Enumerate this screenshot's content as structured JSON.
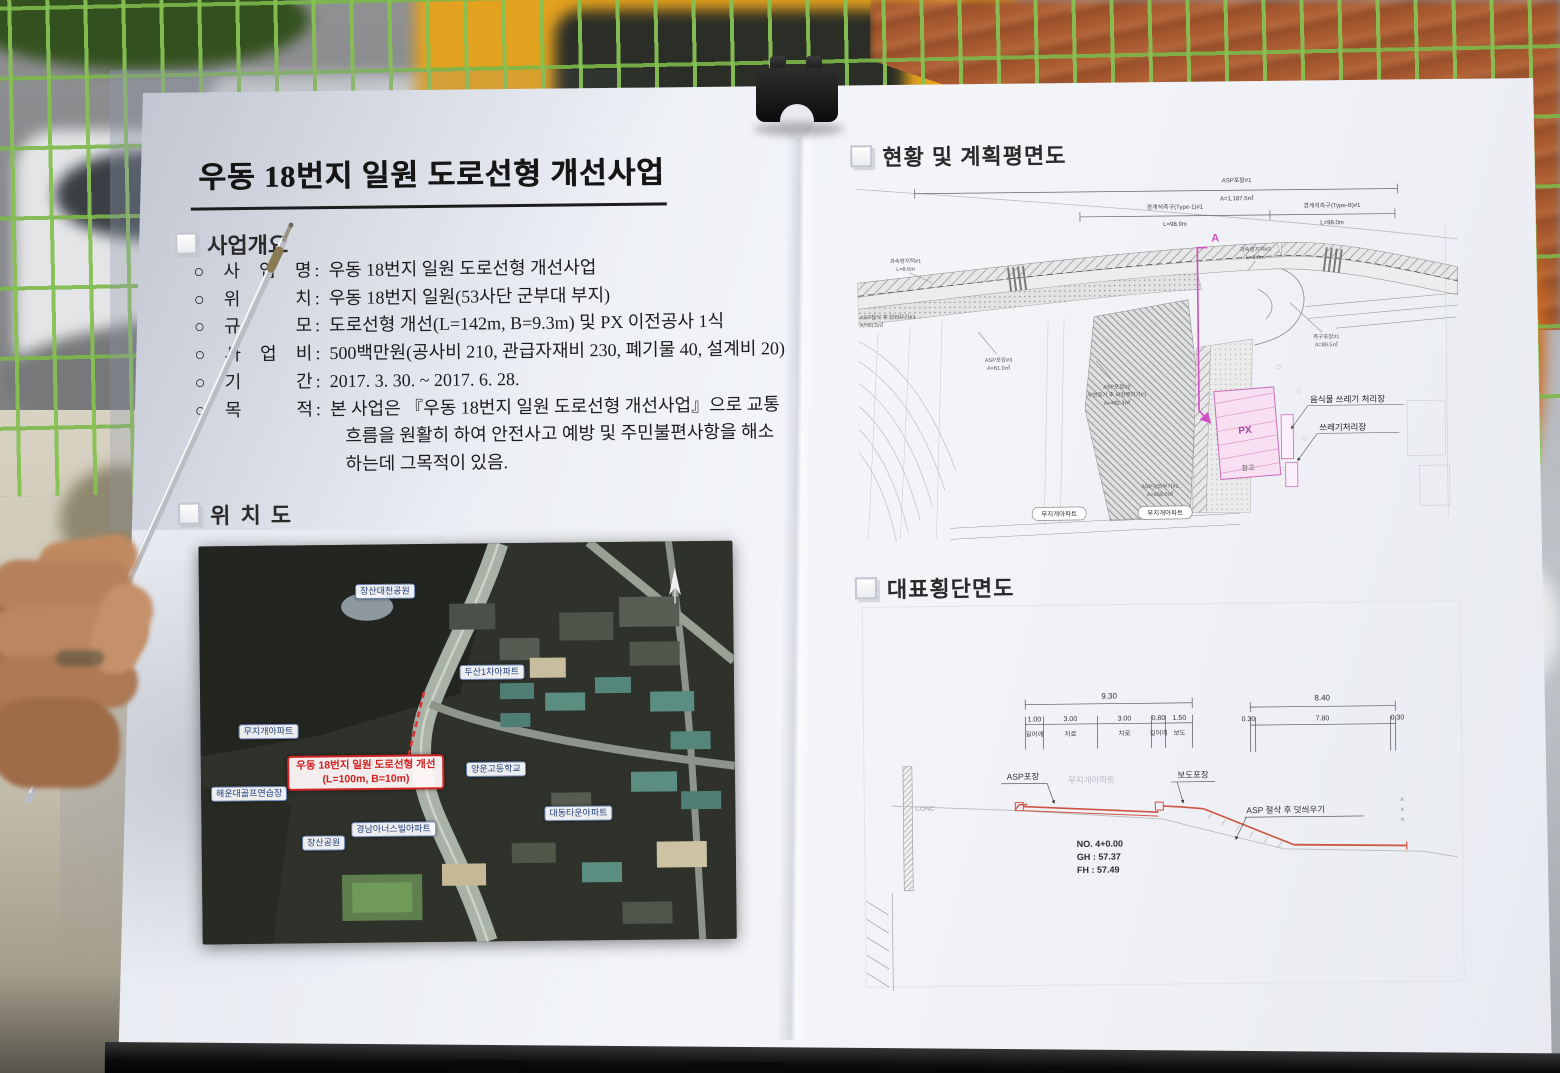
{
  "board": {
    "left_page": {
      "title": "우동 18번지 일원 도로선형 개선사업",
      "overview": {
        "heading": "사업개요",
        "bullet": "○",
        "separator": ":",
        "items": [
          {
            "label": "사 업 명",
            "value": "우동 18번지 일원 도로선형 개선사업"
          },
          {
            "label": "위 치",
            "value": "우동 18번지 일원(53사단 군부대 부지)"
          },
          {
            "label": "규 모",
            "value": "도로선형 개선(L=142m, B=9.3m) 및 PX 이전공사 1식"
          },
          {
            "label": "사 업 비",
            "value": "500백만원(공사비 210, 관급자재비 230, 폐기물 40, 설계비 20)"
          },
          {
            "label": "기 간",
            "value": "2017. 3. 30. ~ 2017. 6. 28."
          },
          {
            "label": "목 적",
            "value": "본 사업은 『우동 18번지 일원 도로선형 개선사업』으로 교통",
            "cont1": "흐름을 원활히 하여 안전사고 예방 및 주민불편사항을 해소",
            "cont2": "하는데 그목적이 있음."
          }
        ]
      },
      "location_map": {
        "heading": "위 치 도",
        "labels": [
          {
            "text": "장산대천공원"
          },
          {
            "text": "두산1차아파트"
          },
          {
            "text": "무지개아파트"
          },
          {
            "text": "해운대골프연습장"
          },
          {
            "text": "양운고등학교"
          },
          {
            "text": "경남아너스빌아파트"
          },
          {
            "text": "장산공원"
          },
          {
            "text": "대동타운아파트"
          }
        ],
        "highlight": {
          "line1": "우동 18번지 일원 도로선형 개선",
          "line2": "(L=100m, B=10m)"
        }
      }
    },
    "right_page": {
      "plan": {
        "heading": "현황 및 계획평면도",
        "section_marker": "A",
        "px_label": "PX",
        "warehouse_label": "창고",
        "waste_labels": [
          {
            "text": "음식물 쓰레기 처리장"
          },
          {
            "text": "쓰레기처리장"
          }
        ],
        "apt_labels": [
          {
            "text": "무지개아파트"
          },
          {
            "text": "무지개아파트"
          }
        ],
        "notes": [
          {
            "l1": "ASP포장#1",
            "l2": "A=1,187.5㎡"
          },
          {
            "l1": "경계석측구(Type-1)#1",
            "l2": "L=98.9m"
          },
          {
            "l1": "경계석측구(Type-B)#1",
            "l2": "L=98.0m"
          },
          {
            "l1": "과속방지턱#1",
            "l2": "L=8.0m"
          },
          {
            "l1": "과속방지턱#2",
            "l2": "L=8.0m"
          },
          {
            "l1": "ASP절삭 후 덧씌우기#1",
            "l2": "A=94.0㎡"
          },
          {
            "l1": "ASP포장#3",
            "l2": "A=81.0㎡"
          },
          {
            "l1": "ASP포장#2",
            "l2": "A=88.5㎡"
          },
          {
            "l1": "사면깎기 후 씨앗뿌리기#1",
            "l2": "A=482.3㎡"
          },
          {
            "l1": "ASP덧씌우기#1",
            "l2": "A=459.0㎡"
          },
          {
            "l1": "측구포장#1",
            "l2": "A=89.5㎡"
          }
        ]
      },
      "cross_section": {
        "heading": "대표횡단면도",
        "left_dims": {
          "total": "9.30",
          "segments": [
            "1.00",
            "3.00",
            "3.00",
            "0.80",
            "1.50"
          ],
          "segment_names": [
            "길어깨",
            "차로",
            "차로",
            "길어깨",
            "보도"
          ]
        },
        "right_dims": {
          "total": "8.40",
          "segments": [
            "0.30",
            "7.80",
            "0.30"
          ]
        },
        "labels": {
          "asp": "ASP포장",
          "apt": "무지개아파트",
          "sidewalk": "보도포장",
          "overlay": "ASP 절삭 후 덧씌우기",
          "wall": "CONC"
        },
        "station": {
          "no": "NO. 4+0.00",
          "gh": "GH : 57.37",
          "fh": "FH : 57.49"
        }
      }
    }
  },
  "colors": {
    "board": "#eef0f5",
    "fence_green": "#86c154",
    "roof_orange": "#a8592f",
    "bus_yellow": "#e8a31d",
    "highlight_red": "#d22323",
    "map_label_blue": "#26407c",
    "section_magenta": "#cf4fc4",
    "profile_red": "#cc5544"
  }
}
